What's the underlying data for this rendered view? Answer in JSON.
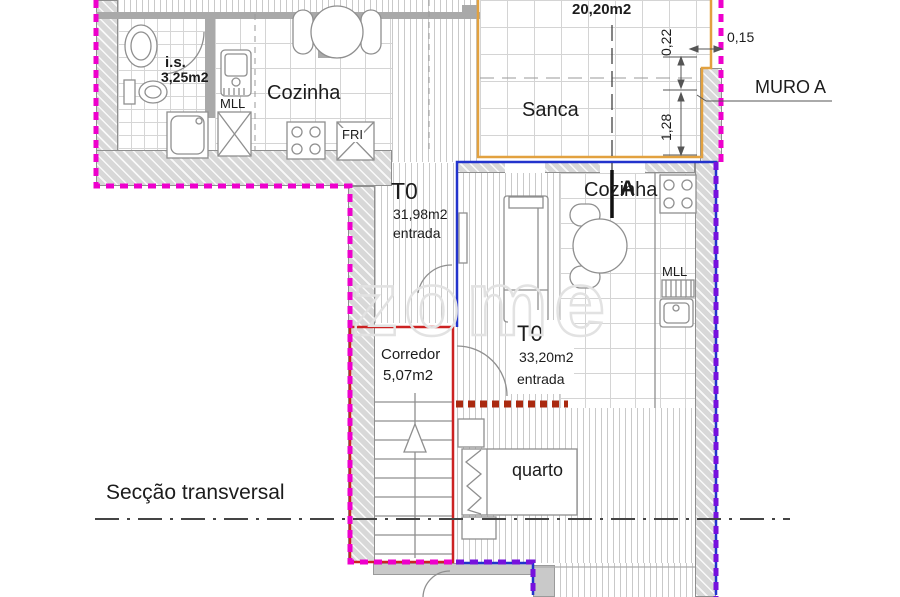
{
  "colors": {
    "magenta": "#ee00cc",
    "purple": "#7711dd",
    "blue": "#2233cc",
    "red": "#cc2222",
    "maroon": "#aa2a10",
    "orange": "#e2a13f",
    "dim": "#555555",
    "section": "#444444",
    "fixture": "#8f8f8f"
  },
  "units": {
    "left": {
      "type": "T0",
      "area": "31,98m2",
      "entry": "entrada"
    },
    "right": {
      "type": "T0",
      "area": "33,20m2",
      "entry": "entrada"
    }
  },
  "rooms": {
    "bathroom": {
      "name": "i.s.",
      "area": "3,25m2"
    },
    "kitchen_left": "Cozinha",
    "kitchen_right": "Cozinha",
    "sanca": "Sanca",
    "sanca_area": "20,20m2",
    "corridor": {
      "name": "Corredor",
      "area": "5,07m2"
    },
    "bedroom": "quarto"
  },
  "fixtures": {
    "sink_left": "MLL",
    "sink_right": "MLL",
    "fridge": "FRI"
  },
  "dimensions": {
    "d_022": "0,22",
    "d_015": "0,15",
    "d_128": "1,28"
  },
  "annotations": {
    "wall_label": "MURO A",
    "section_title": "Secção transversal",
    "section_marker": "A"
  },
  "watermark": "zome"
}
